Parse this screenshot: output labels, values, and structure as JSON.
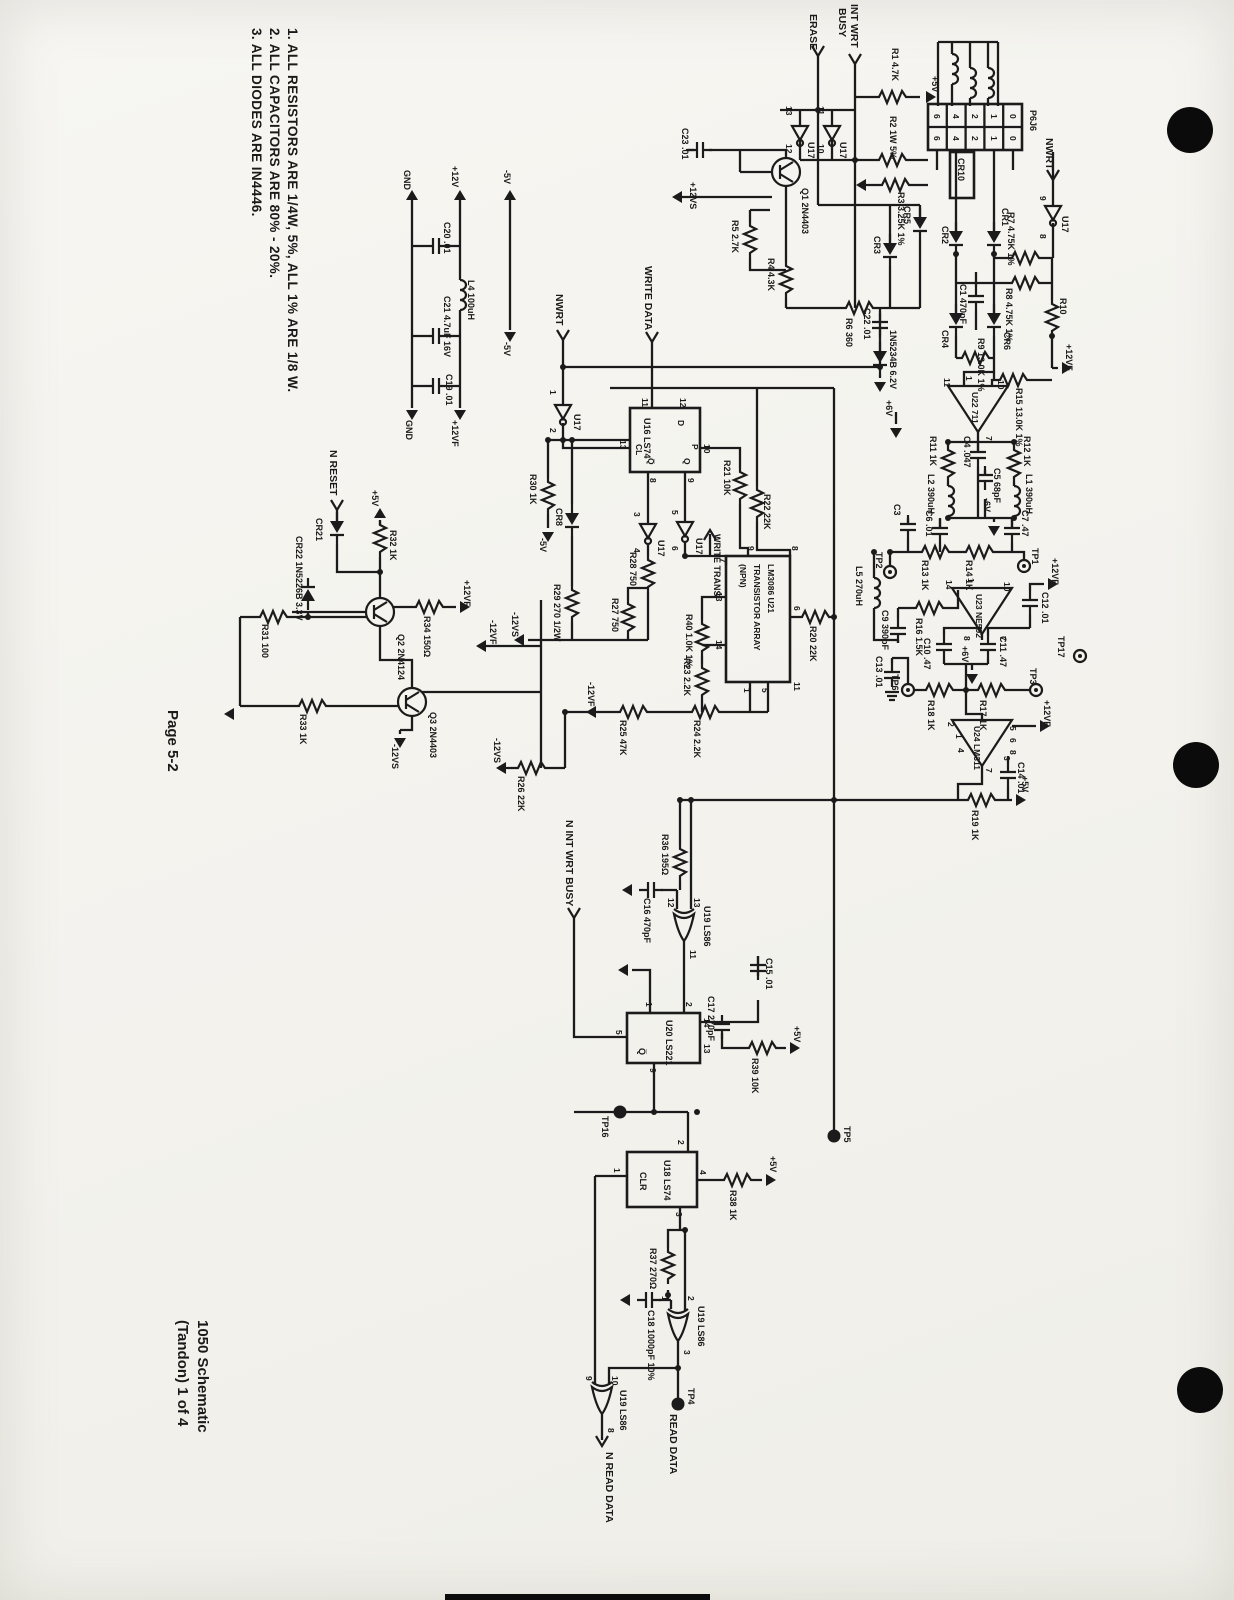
{
  "page": {
    "number": "Page 5-2",
    "title_line1": "1050 Schematic",
    "title_line2": "(Tandon) 1 of 4"
  },
  "notes": {
    "n3": "3. ALL DIODES ARE IN4446.",
    "n2": "2. ALL CAPACITORS ARE 80% - 20%.",
    "n1": "1. ALL RESISTORS ARE 1/4W, 5%, ALL 1% ARE 1/8 W."
  },
  "signals": {
    "erase": "ERASE",
    "int_wrt": "INT WRT",
    "busy": "BUSY",
    "nwrt": "NWRT",
    "write_data": "WRITE DATA",
    "write_trans": "WRITE TRANS",
    "n_reset": "N RESET",
    "n_int_wrt_busy": "N INT WRT BUSY",
    "read_data": "READ DATA",
    "n_read_data": "N READ DATA"
  },
  "power": {
    "p5v": "+5V",
    "m5v": "-5V",
    "p12v": "+12V",
    "gnd": "GND",
    "p12vf": "+12VF",
    "m12vf": "-12VF",
    "p12vs": "+12VS",
    "m12vs": "-12VS",
    "p6v": "+6V",
    "m6v": "-6V"
  },
  "components": {
    "r1": "R1 4.7K",
    "r2": "R2 1W 5%",
    "r3": "R3 3.25K 1%",
    "r4": "R4 4.3K",
    "r5": "R5 2.7K",
    "r6": "R6 360",
    "r7": "R7 4.75K 1%",
    "r8": "R8 4.75K 1%",
    "r9": "R9 13.0K 1%",
    "r10": "R10",
    "r11": "R11 1K",
    "r12": "R12 1K",
    "r13": "R13 1K",
    "r14": "R14 1K",
    "r15": "R15 13.0K 1%",
    "r16": "R16 1.5K",
    "r17": "R17 1K",
    "r18": "R18 1K",
    "r19": "R19 1K",
    "r20": "R20 22K",
    "r21": "R21 10K",
    "r22": "R22 22K",
    "r23": "R23 2.2K",
    "r24": "R24 2.2K",
    "r25": "R25 47K",
    "r26": "R26 22K",
    "r27": "R27 750",
    "r28": "R28 750",
    "r29": "R29 270 1/2W",
    "r30": "R30 1K",
    "r31": "R31 100",
    "r32": "R32 1K",
    "r33": "R33 1K",
    "r34": "R34 150Ω",
    "r36": "R36 195Ω",
    "r37": "R37 270Ω",
    "r38": "R38 1K",
    "r39": "R39 10K",
    "r40": "R40 1.0K 1%",
    "c1": "C1 470pF",
    "c3": "C3",
    "c4": "C4 .047",
    "c5": "C5 68pF",
    "c6": "C6 .01",
    "c7": "C7 .47",
    "c9": "C9 390pF",
    "c10": "C10 .47",
    "c11": "C11 .47",
    "c12": "C12 .01",
    "c13": "C13 .01",
    "c14": "C14 .01",
    "c15": "C15 .01",
    "c16": "C16 470pF",
    "c17": "C17 270pF",
    "c18": "C18 1000pF 10%",
    "c19": "C19 .01",
    "c20": "C20 .01",
    "c21": "C21 4.7uF 16V",
    "c22": "C22 .01",
    "c23": "C23 .01",
    "l1": "L1 390uH",
    "l2": "L2 390uH",
    "l4": "L4 100uH",
    "l5": "L5 270uH",
    "cr1": "CR1",
    "cr2": "CR2",
    "cr3": "CR3",
    "cr4": "CR4",
    "cr5": "CR5",
    "cr6": "CR6",
    "cr8": "CR8",
    "cr10": "CR10",
    "cr21": "CR21",
    "cr22": "CR22 1N5226B 3.3V",
    "zener": "1N5234B 6.2V",
    "q1": "Q1 2N4403",
    "q2": "Q2 2N4124",
    "q3": "Q3 2N4403"
  },
  "ics": {
    "u16": "U16 LS74",
    "u17": "U17",
    "u18": "U18 LS74",
    "u19": "U19 LS86",
    "u20": "U20 LS221",
    "u21_l1": "LM3086 U21",
    "u21_l2": "TRANSISTOR ARRAY",
    "u21_l3": "(NPN)",
    "u22": "U22 711",
    "u23": "U23 NE592",
    "u24": "U24 LM311",
    "d": "D",
    "p": "P",
    "cl": "CL",
    "q": "Q",
    "qbar": "Q̅",
    "clr": "CLR"
  },
  "testpoints": {
    "tp1": "TP1",
    "tp2": "TP2",
    "tp3": "TP3",
    "tp4": "TP4",
    "tp5": "TP5",
    "tp6": "TP6",
    "tp16": "TP16",
    "tp17": "TP17"
  },
  "connector": {
    "name": "P6J6",
    "pins": [
      "6",
      "4",
      "2",
      "1",
      "0"
    ]
  },
  "pins": {
    "u16": [
      "11",
      "12",
      "13",
      "10",
      "9",
      "8"
    ],
    "u17a": [
      "13",
      "12"
    ],
    "u17b": [
      "11",
      "10"
    ],
    "u17c": [
      "9",
      "8"
    ],
    "u17d": [
      "1",
      "2"
    ],
    "u17e": [
      "3",
      "4"
    ],
    "u17f": [
      "5",
      "6"
    ],
    "u19x1": [
      "12",
      "13",
      "11"
    ],
    "u19x2": [
      "1",
      "2",
      "3"
    ],
    "u19x3": [
      "9",
      "10",
      "8"
    ],
    "u20": [
      "1",
      "2",
      "14",
      "13",
      "9",
      "5"
    ],
    "u18": [
      "1",
      "2",
      "3",
      "4"
    ],
    "u21": [
      "7",
      "9",
      "8",
      "13",
      "14",
      "6",
      "1",
      "5",
      "11"
    ],
    "u22": [
      "11",
      "1",
      "10",
      "7"
    ],
    "u23": [
      "14",
      "1",
      "10",
      "8",
      "7"
    ],
    "u24": [
      "2",
      "1",
      "4",
      "5",
      "6",
      "8",
      "3",
      "7"
    ]
  }
}
